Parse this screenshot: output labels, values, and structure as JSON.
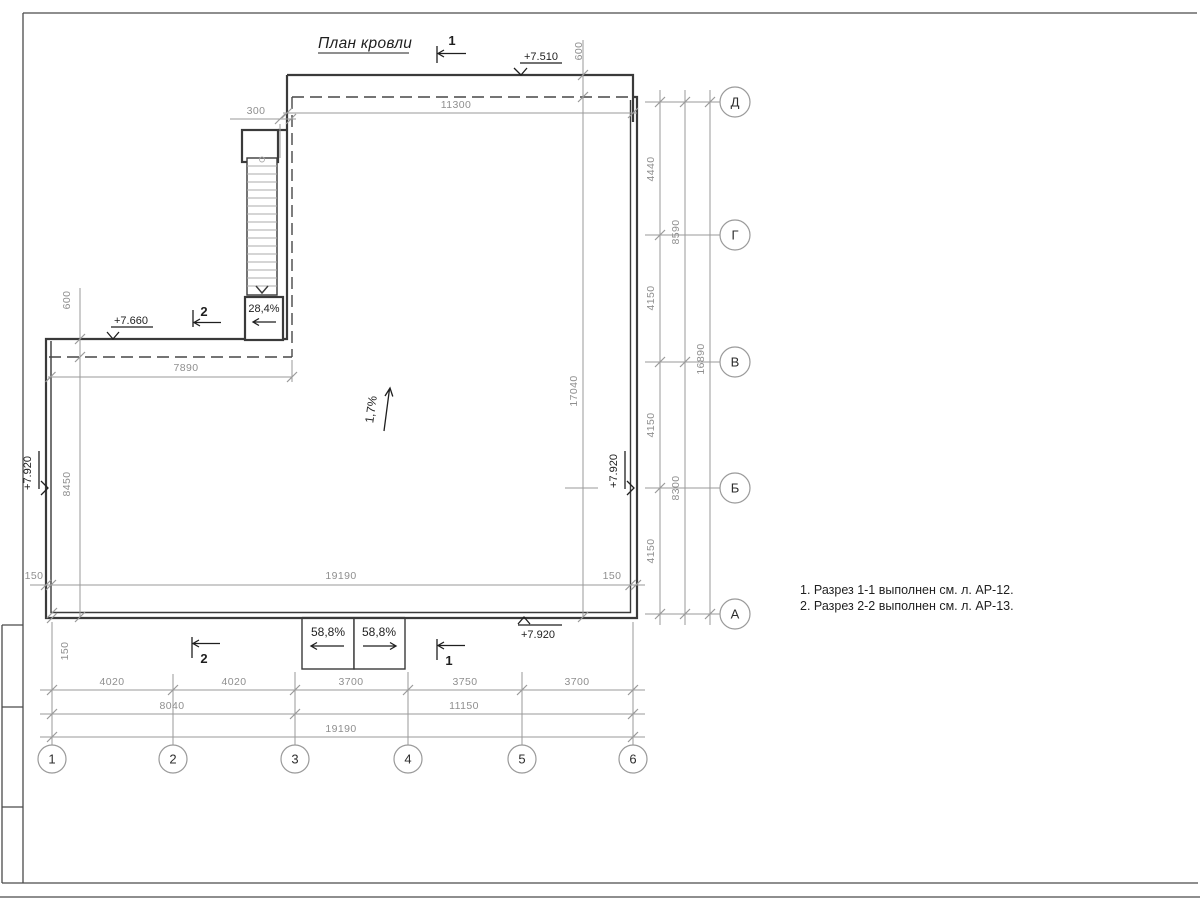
{
  "sheet": {
    "title": "План кровли"
  },
  "notes": [
    "1. Разрез 1-1 выполнен см. л. АР-12.",
    "2. Разрез 2-2 выполнен см. л. АР-13."
  ],
  "axis_labels": {
    "bottom": [
      "1",
      "2",
      "3",
      "4",
      "5",
      "6"
    ],
    "right": [
      "Д",
      "Г",
      "В",
      "Б",
      "А"
    ]
  },
  "dimensions": {
    "top": {
      "parapet_offset": "600",
      "main_width": "11300",
      "stair_offset": "300"
    },
    "wing": {
      "parapet_offset": "600",
      "width": "7890",
      "height": "8450"
    },
    "interior": {
      "width": "19190",
      "height": "17040",
      "wall_left": "150",
      "wall_right": "150",
      "wall_bottom": "150"
    },
    "right_tier1": [
      "4440",
      "4150",
      "4150",
      "4150"
    ],
    "right_tier2": [
      "8590",
      "8300"
    ],
    "right_total": "16890",
    "bottom_tier1": [
      "4020",
      "4020",
      "3700",
      "3750",
      "3700"
    ],
    "bottom_tier2": [
      "8040",
      "11150"
    ],
    "bottom_total": "19190"
  },
  "elevations": {
    "top": "+7.510",
    "wing": "+7.660",
    "bottom": "+7.920",
    "left": "+7.920",
    "right": "+7.920"
  },
  "slopes": {
    "roof": "1,7%",
    "stair": "28,4%",
    "ramp_left": "58,8%",
    "ramp_right": "58,8%"
  },
  "section_marks": {
    "s1": "1",
    "s2": "2"
  }
}
